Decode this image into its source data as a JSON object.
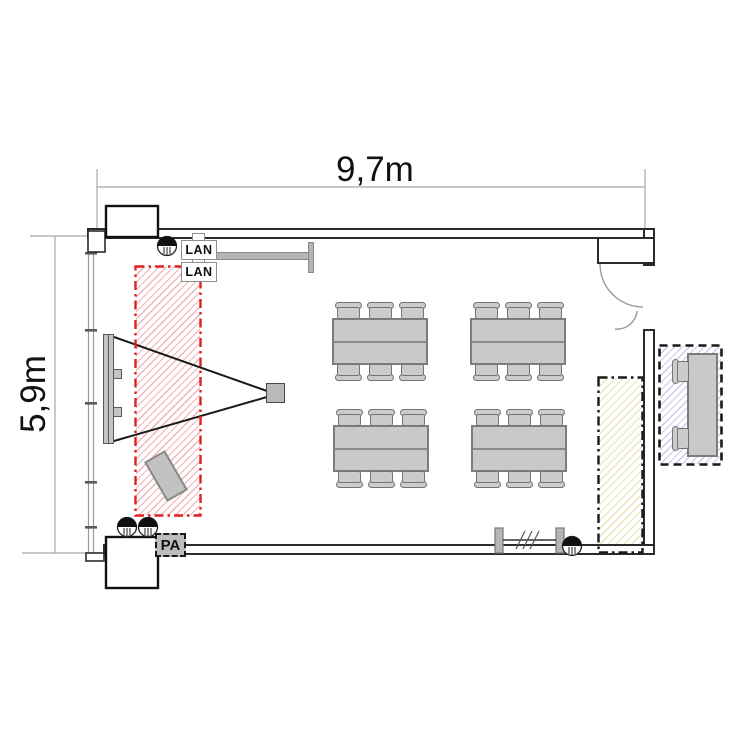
{
  "dimensions": {
    "width_label": "9,7m",
    "height_label": "5,9m"
  },
  "labels": {
    "lan1": "LAN",
    "lan2": "LAN",
    "pa": "PA"
  },
  "zones": {
    "projection_zone": {
      "name": "projection-keepout-zone",
      "border_color": "#e02020",
      "border_style": "dash-dot"
    },
    "wall_strip_zone": {
      "name": "reserved-wall-strip",
      "border_color": "#1a1a1a",
      "border_style": "dash-dot"
    },
    "external_desk_zone": {
      "name": "external-desk-zone",
      "border_color": "#1a1a1a",
      "border_style": "dashed"
    }
  },
  "furniture": {
    "table": {
      "w": 96,
      "h": 47
    },
    "chair_offsets": [
      3,
      35,
      67
    ],
    "table_groups": [
      {
        "x": 332,
        "y": 318
      },
      {
        "x": 470,
        "y": 318
      },
      {
        "x": 333,
        "y": 425
      },
      {
        "x": 471,
        "y": 425
      }
    ],
    "chairs_per_group": 6,
    "external_desk": {
      "x": 687,
      "y": 353,
      "w": 31,
      "h": 104,
      "chair_ys": [
        359,
        426
      ]
    }
  },
  "colors": {
    "wall": "#2b2b2b",
    "furniture_fill": "#c9c9c9",
    "furniture_border": "#7d7d7d",
    "hatch_red": "#e15555",
    "hatch_yellow": "#cdc35a",
    "hatch_blue": "#877dd7"
  }
}
